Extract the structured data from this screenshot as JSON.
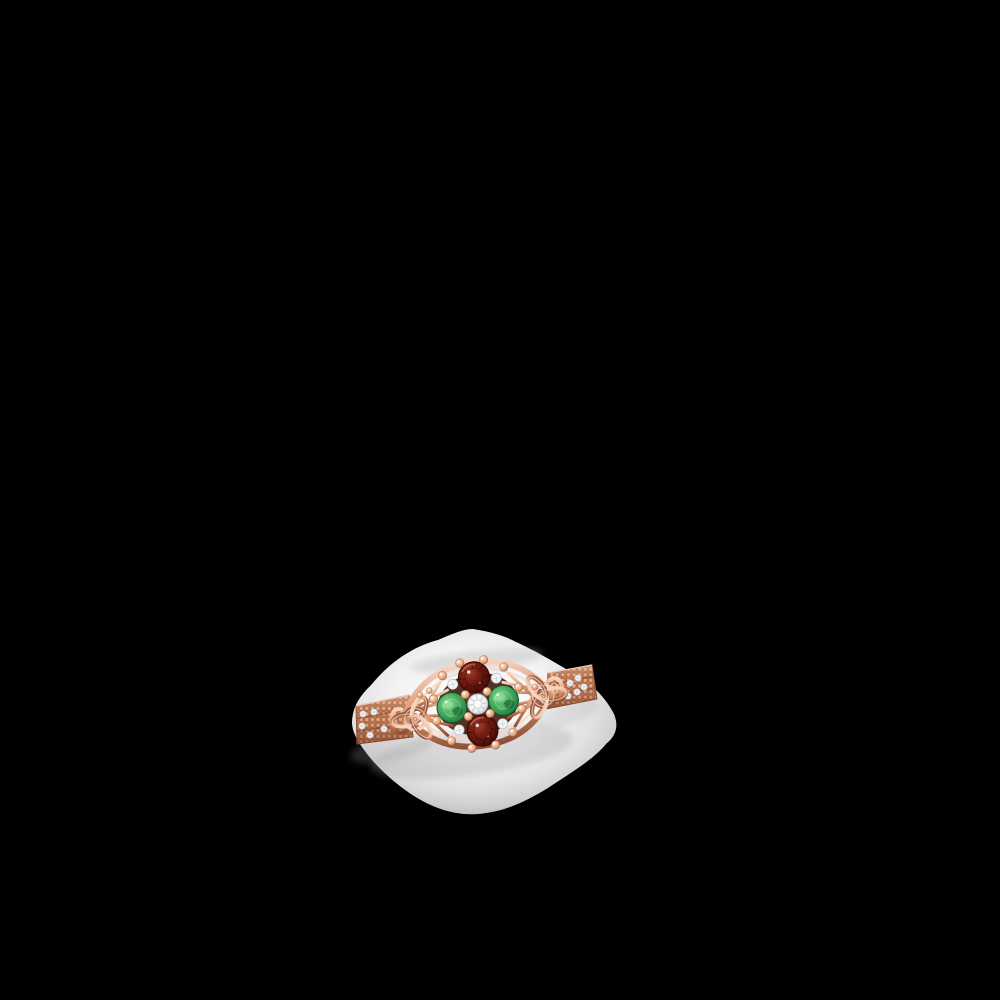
{
  "scene": {
    "type": "product-photo",
    "subject": "celtic-knot-cluster-ring",
    "metal": "rose-gold",
    "backdrop": "soft-white-glow-on-black",
    "stones": {
      "top": "garnet",
      "bottom": "garnet",
      "left": "emerald",
      "right": "emerald",
      "center": "diamond",
      "accent_diamond_count": 4,
      "left_band_diamond_count": 5,
      "right_band_diamond_count": 5
    },
    "motifs": [
      "trinity-knot-left",
      "trinity-knot-right",
      "marquise-lattice-frame",
      "milgrain-band"
    ]
  },
  "colors": {
    "background": "#000000",
    "blob_center": "#ffffff",
    "blob_mid": "#f3f3f3",
    "blob_fade": "#e2e2e2",
    "blob_dim": "#cfcfcf",
    "blob_edge": "#b7b7b7",
    "shadow": "#9a9a9a",
    "gold_light": "#f7d5c0",
    "gold_mid": "#dd9a76",
    "gold_deep": "#c07b55",
    "gold_dark": "#8e4f34",
    "bead_light": "#fbe7d8",
    "bead_mid": "#e8ae87",
    "bead_dark": "#a5613c",
    "garnet_light": "#9e3d2a",
    "garnet_mid": "#7a1f12",
    "garnet_deep": "#55100a",
    "garnet_dark": "#3c0b06",
    "emerald_light": "#8fdc9a",
    "emerald_mid": "#4cb162",
    "emerald_deep": "#2b8a46",
    "emerald_dark": "#1c6233",
    "diamond_white": "#ffffff",
    "diamond_soft": "#f0f1f3",
    "diamond_gray": "#c4c9cf",
    "frame_interior": "#45200f"
  }
}
